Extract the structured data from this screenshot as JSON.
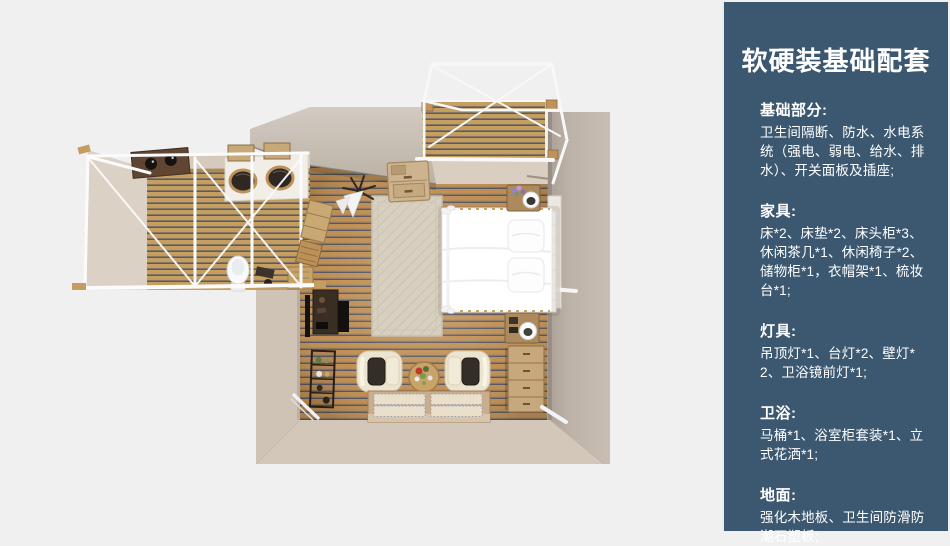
{
  "panel": {
    "title": "软硬装基础配套",
    "bg_color": "#3b5870",
    "text_color": "#ffffff",
    "sections": [
      {
        "heading": "基础部分:",
        "body": "卫生间隔断、防水、水电系统（强电、弱电、给水、排水）、开关面板及插座;"
      },
      {
        "heading": "家具:",
        "body": "床*2、床垫*2、床头柜*3、休闲茶几*1、休闲椅子*2、储物柜*1，衣帽架*1、梳妆台*1;"
      },
      {
        "heading": "灯具:",
        "body": "吊顶灯*1、台灯*2、壁灯*2、卫浴镜前灯*1;"
      },
      {
        "heading": "卫浴:",
        "body": "马桶*1、浴室柜套装*1、立式花洒*1;"
      },
      {
        "heading": "地面:",
        "body": "强化木地板、卫生间防滑防潮石塑板;"
      }
    ]
  },
  "floorplan": {
    "render_type": "top-down 3D room render",
    "colors": {
      "background": "#f0f0f1",
      "wall": "#d2c6b9",
      "floor_wood": "#bd8a4e",
      "deck_wood": "#c59e60",
      "frame_white": "#f8f8f8",
      "bed": "#ffffff"
    }
  }
}
